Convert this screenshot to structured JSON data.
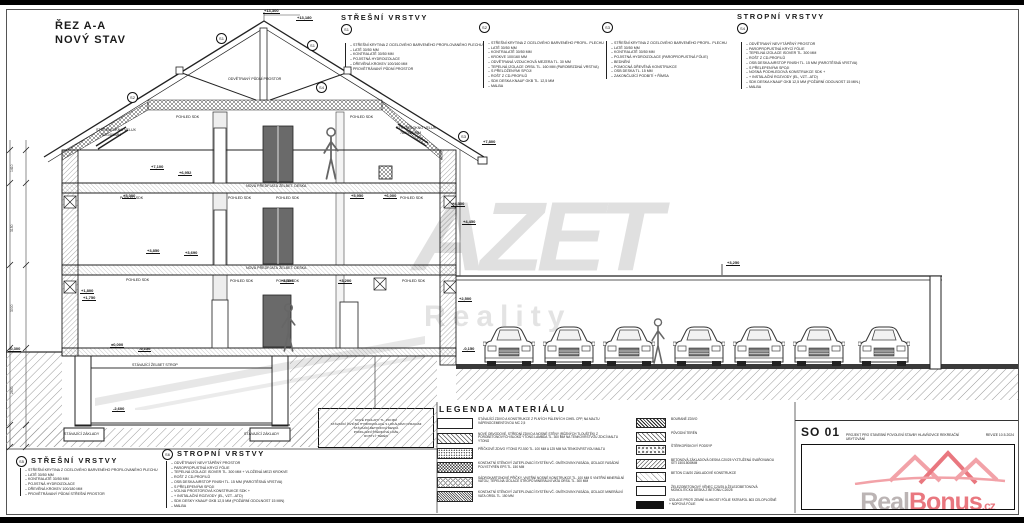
{
  "title": {
    "line1": "ŘEZ A-A",
    "line2": "NOVÝ STAV"
  },
  "layer_blocks": {
    "s1": {
      "id": "S1",
      "header": "STŘEŠNÍ VRSTVY",
      "items": [
        "STŘEŠNÍ KRYTINA Z OCELOVÉHO BARVENÉHO PROFILOVANÉHO PLECHU",
        "LATĚ 30/50 MM",
        "KONTRALATĚ 30/50 MM",
        "POJISTNÁ HYDROIZOLACE",
        "DŘEVĚNÁ KROKEV 100/160 MM",
        "PROVĚTRÁVANÝ PŮDNÍ PROSTOR"
      ]
    },
    "s2": {
      "id": "S2",
      "header": "",
      "items": [
        "STŘEŠNÍ KRYTINA Z OCELOVÉHO BARVENÉHO PROFIL. PLECHU",
        "LATĚ 30/50 MM",
        "KONTRALATĚ 30/50 MM",
        "KROKVE 100/160 MM",
        "ODVĚTRANÁ VZDUCHOVÁ MEZERA TL. 30 MM",
        "TEPELNÁ IZOLACE ORSIL TL. 160 MM (PAROBRZDNÁ VRSTVA)",
        "S PŘELOŽENÝMI SPOJI",
        "ROŠT Z CD-PROFILŮ",
        "SDK DESKA KNAUF GKB TL. 12,5 MM",
        "MALBA"
      ]
    },
    "s3": {
      "id": "S3",
      "header": "",
      "items": [
        "STŘEŠNÍ KRYTINA Z OCELOVÉHO BARVENÉHO PROFIL. PLECHU",
        "LATĚ 30/50 MM",
        "KONTRALATĚ 30/50 MM",
        "POJISTNÁ HYDROIZOLACE (PAROPROPUSTNÁ FÓLIE)",
        "BEDNĚNÍ",
        "POMOCNÁ DŘEVĚNÁ KONSTRUKCE",
        "OSB DESKA TL. 15 MM",
        "ZAKONČUJÍCÍ PODBITÍ + ŘÍMSA"
      ]
    },
    "s4": {
      "id": "S4",
      "header": "STROPNÍ VRSTVY",
      "items": [
        "ODVĚTRANÝ NEVYTÁPĚNÝ PROSTOR",
        "PAROPROPUSTNÁ KRYCÍ FÓLIE",
        "TEPELNÁ IZOLACE ISOVER TL. 300 MM",
        "ROŠT Z CD-PROFILŮ",
        "OSB DESKA AIRSTOP FINISH TL. 15 MM (PAROTĚSNÁ VRSTVA)",
        "S PŘELEPENÝMI SPOJI",
        "NOSNÁ PODHLEDOVÁ KONSTRUKCE SDK +",
        "+ INSTALAČNÍ ROZVODY (EL, VZT...ATD)",
        "SDK DESKA KNAUF GKB 12,5 MM (POŽÁRNÍ ODOLNOST 15 MIN.)",
        "MALBA"
      ]
    },
    "s5": {
      "id": "S5",
      "header": "STŘEŠNÍ VRSTVY",
      "items": [
        "STŘEŠNÍ KRYTINA Z OCELOVÉHO BARVENÉHO PROFILOVANÉHO PLECHU",
        "LATĚ 30/50 MM",
        "KONTRALATĚ 30/50 MM",
        "POJISTNÁ HYDROIZOLACE",
        "DŘEVĚNÁ KROKEV 100/180 MM",
        "PROVĚTRÁVANÝ PŮDNÍ STŘEŠNÍ PROSTOR"
      ]
    },
    "s6": {
      "id": "S6",
      "header": "STROPNÍ VRSTVY",
      "items": [
        "ODVĚTRANÝ NEVYTÁPĚNÝ PROSTOR",
        "PAROPROPUSTNÁ KRYCÍ FÓLIE",
        "TEPELNÁ IZOLACE ISOVER TL. 300 MM + VLOŽENÁ MEZI KROKVE",
        "ROŠT Z CD-PROFILŮ",
        "OSB DESKA AIRSTOP FINISH TL. 15 MM (PAROTĚSNÁ VRSTVA)",
        "S PŘELEPENÝMI SPOJI",
        "VOLNÁ PROSTOROVÁ KONSTRUKCE SDK +",
        "+ INSTALAČNÍ ROZVODY (EL, VZT...ATD)",
        "SDK DESKY KNAUF GKB 12,5 MM (POŽÁRNÍ ODOLNOST 15 MIN)",
        "MALBA"
      ]
    }
  },
  "legend": {
    "title": "LEGENDA MATERIÁLU",
    "left": [
      {
        "swatch": "plain",
        "text": "STÁVAJÍCÍ ZDIVO A KONSTRUKCE Z PLNÝCH PÁLENÝCH CIHEL CPP, NA MALTU VÁPENOCEMENTOVOU MC 2,5"
      },
      {
        "swatch": "diag",
        "text": "NOVÉ OBVODOVÉ, STŘEDNÍ ZDIVO A NOSNÉ STĚNY (RŮZNÝCH TLOUŠTĚK) Z POROBETONOVÝCH BLOKŮ YTONG LAMBDA TL. 300 MM NA TENKOVRSTVOU ZDICÍ MALTU YTONG"
      },
      {
        "swatch": "dots",
        "text": "PŘÍČKOVÉ ZDIVO YTONG P2-500 TL. 100 MM A 125 MM NA TENKOVRSTVOU MALTU"
      },
      {
        "swatch": "checker",
        "text": "KONTAKTNÍ STĚNOVÝ ZATEPLOVACÍ SYSTÉM VČ. OMÍTKOVINY-FASÁDA, IZOLACE FASÁDNÍ POLYSTYRÉN EPS TL. 150 MM"
      },
      {
        "swatch": "rings",
        "text": "SÁDROKARTONOVÉ PŘÍČKY, VNITŘNÍ NOSNÉ KONSTRUKCE TL. 100 MM S VNITŘNÍ MINERÁLNÍ VATOU, TEPELNÁ IZOLACE STROPŮ MINERÁLNÍ VATA ORSIL TL. 300 MM"
      },
      {
        "swatch": "dense",
        "text": "KONTAKTNÍ STĚNOVÝ ZATEPLOVACÍ SYSTÉM VČ. OMÍTKOVINY-FASÁDA, IZOLACE MINERÁLNÍ VATA ORSIL TL. 150 MM"
      }
    ],
    "right": [
      {
        "swatch": "brick",
        "text": "BOURANÉ ZDIVO"
      },
      {
        "swatch": "diag",
        "text": "PŮVODNÍ TERÉN"
      },
      {
        "swatch": "rubble",
        "text": "ŠTĚRKOPÍSKOVÝ PODSYP"
      },
      {
        "swatch": "diag2",
        "text": "BETONOVÁ ZÁKLADOVÁ DESKA C20/25 VYZTUŽENÁ SVAŘOVANOU SÍTÍ 150/150/8MM"
      },
      {
        "swatch": "lightdiag",
        "text": "BETON C16/20 ZÁKLADOVÉ KONSTRUKCE"
      },
      {
        "swatch": "box",
        "text": "ŽELEZOBETONOVÝ VĚNEC C20/25 A ŽELEZOBETONOVÁ MONOLITICKÁ DESKA Z BETONU C20/25"
      },
      {
        "swatch": "thickline",
        "text": "IZOLACE PROTI ZEMNÍ VLHKOSTI FÓLIE FATRAFOL 803 CELOPLOŠNĚ + NOPOVÁ FÓLIE"
      }
    ]
  },
  "note_box": {
    "lines": [
      "NOVÉ PODLAHY TL. 150 MM",
      "STÁVAJÍCÍ ŽIVIČNÁ HYDROIZOLACE S LOKÁLNÍMI OPRAVAMI",
      "STÁVAJÍCÍ BETONOVÁ DESKA",
      "PODKLADNÍ ŠTĚRKOVÉ LOŽE",
      "ROSTLÝ TERÉN"
    ]
  },
  "annotations": {
    "elevations": [
      {
        "t": "+13,300",
        "x": 263,
        "y": 8
      },
      {
        "t": "+13,180",
        "x": 296,
        "y": 15
      },
      {
        "t": "+7,800",
        "x": 482,
        "y": 139
      },
      {
        "t": "+7,100",
        "x": 150,
        "y": 164
      },
      {
        "t": "+6,952",
        "x": 178,
        "y": 170
      },
      {
        "t": "+5,000",
        "x": 122,
        "y": 193
      },
      {
        "t": "+5,950",
        "x": 350,
        "y": 193
      },
      {
        "t": "+6,000",
        "x": 383,
        "y": 193
      },
      {
        "t": "+4,300",
        "x": 451,
        "y": 201
      },
      {
        "t": "+4,450",
        "x": 462,
        "y": 219
      },
      {
        "t": "+3,850",
        "x": 146,
        "y": 248
      },
      {
        "t": "+3,690",
        "x": 184,
        "y": 250
      },
      {
        "t": "+3,300",
        "x": 280,
        "y": 278
      },
      {
        "t": "+3,200",
        "x": 338,
        "y": 278
      },
      {
        "t": "+3,250",
        "x": 726,
        "y": 260
      },
      {
        "t": "+2,500",
        "x": 458,
        "y": 296
      },
      {
        "t": "+1,800",
        "x": 80,
        "y": 288
      },
      {
        "t": "+1,750",
        "x": 82,
        "y": 295
      },
      {
        "t": "±0,000",
        "x": 110,
        "y": 342
      },
      {
        "t": "-0,150",
        "x": 138,
        "y": 346
      },
      {
        "t": "-0,150",
        "x": 462,
        "y": 346
      },
      {
        "t": "-2,600",
        "x": 112,
        "y": 406
      },
      {
        "t": "-0,300",
        "x": 8,
        "y": 346
      }
    ],
    "labels": [
      {
        "t": "ODVĚTRANÝ PŮDNÍ PROSTOR",
        "x": 228,
        "y": 77
      },
      {
        "t": "STŘEŠNÍ OKNO VELUX",
        "x": 96,
        "y": 128
      },
      {
        "t": "780/1400MM",
        "x": 100,
        "y": 133
      },
      {
        "t": "STŘEŠNÍ OKNO VELUX",
        "x": 396,
        "y": 126
      },
      {
        "t": "780/1400MM",
        "x": 400,
        "y": 131
      },
      {
        "t": "POHLED SDK",
        "x": 176,
        "y": 115
      },
      {
        "t": "POHLED SDK",
        "x": 350,
        "y": 115
      },
      {
        "t": "POHLED SDK",
        "x": 120,
        "y": 196
      },
      {
        "t": "POHLED SDK",
        "x": 228,
        "y": 196
      },
      {
        "t": "POHLED SDK",
        "x": 276,
        "y": 196
      },
      {
        "t": "POHLED SDK",
        "x": 400,
        "y": 196
      },
      {
        "t": "POHLED SDK",
        "x": 126,
        "y": 278
      },
      {
        "t": "POHLED SDK",
        "x": 230,
        "y": 279
      },
      {
        "t": "POHLED SDK",
        "x": 276,
        "y": 279
      },
      {
        "t": "POHLED SDK",
        "x": 402,
        "y": 279
      },
      {
        "t": "NOVÁ PŘEDPJATÁ ŽELBET. DESKA",
        "x": 246,
        "y": 184
      },
      {
        "t": "NOVÁ PŘEDPJATÁ ŽELBET. DESKA",
        "x": 246,
        "y": 266
      },
      {
        "t": "STÁVAJÍCÍ ŽELBET STROP",
        "x": 132,
        "y": 363
      },
      {
        "t": "STÁVAJÍCÍ ZÁKLADY",
        "x": 64,
        "y": 432
      },
      {
        "t": "STÁVAJÍCÍ ZÁKLADY",
        "x": 244,
        "y": 432
      }
    ],
    "badges": [
      {
        "t": "S1",
        "x": 216,
        "y": 33
      },
      {
        "t": "S1",
        "x": 307,
        "y": 40
      },
      {
        "t": "S2",
        "x": 127,
        "y": 92
      },
      {
        "t": "S4",
        "x": 316,
        "y": 82
      },
      {
        "t": "S3",
        "x": 458,
        "y": 131
      }
    ],
    "dims": [
      {
        "t": "1410",
        "x": 10,
        "y": 172
      },
      {
        "t": "3150",
        "x": 10,
        "y": 232
      },
      {
        "t": "3000",
        "x": 10,
        "y": 312
      },
      {
        "t": "2600",
        "x": 10,
        "y": 394
      }
    ]
  },
  "watermarks": {
    "azet": {
      "text": "AZET",
      "sub": "Reality",
      "color": "#c7c7c7"
    },
    "realbonus": {
      "real": "Real",
      "bonus": "Bonus",
      "tld": ".cz",
      "pink": "#e4555f",
      "gray": "#aaa1a1"
    }
  },
  "titleblock": {
    "code": "SO 01",
    "subtitle": "PROJEKT PRO STAVEBNÍ POVOLENÍ STAVBY HLAVŇOVICE REKREAČNÍ UBYTOVÁNÍ",
    "revision": "REVIZE 10.5.2024"
  }
}
